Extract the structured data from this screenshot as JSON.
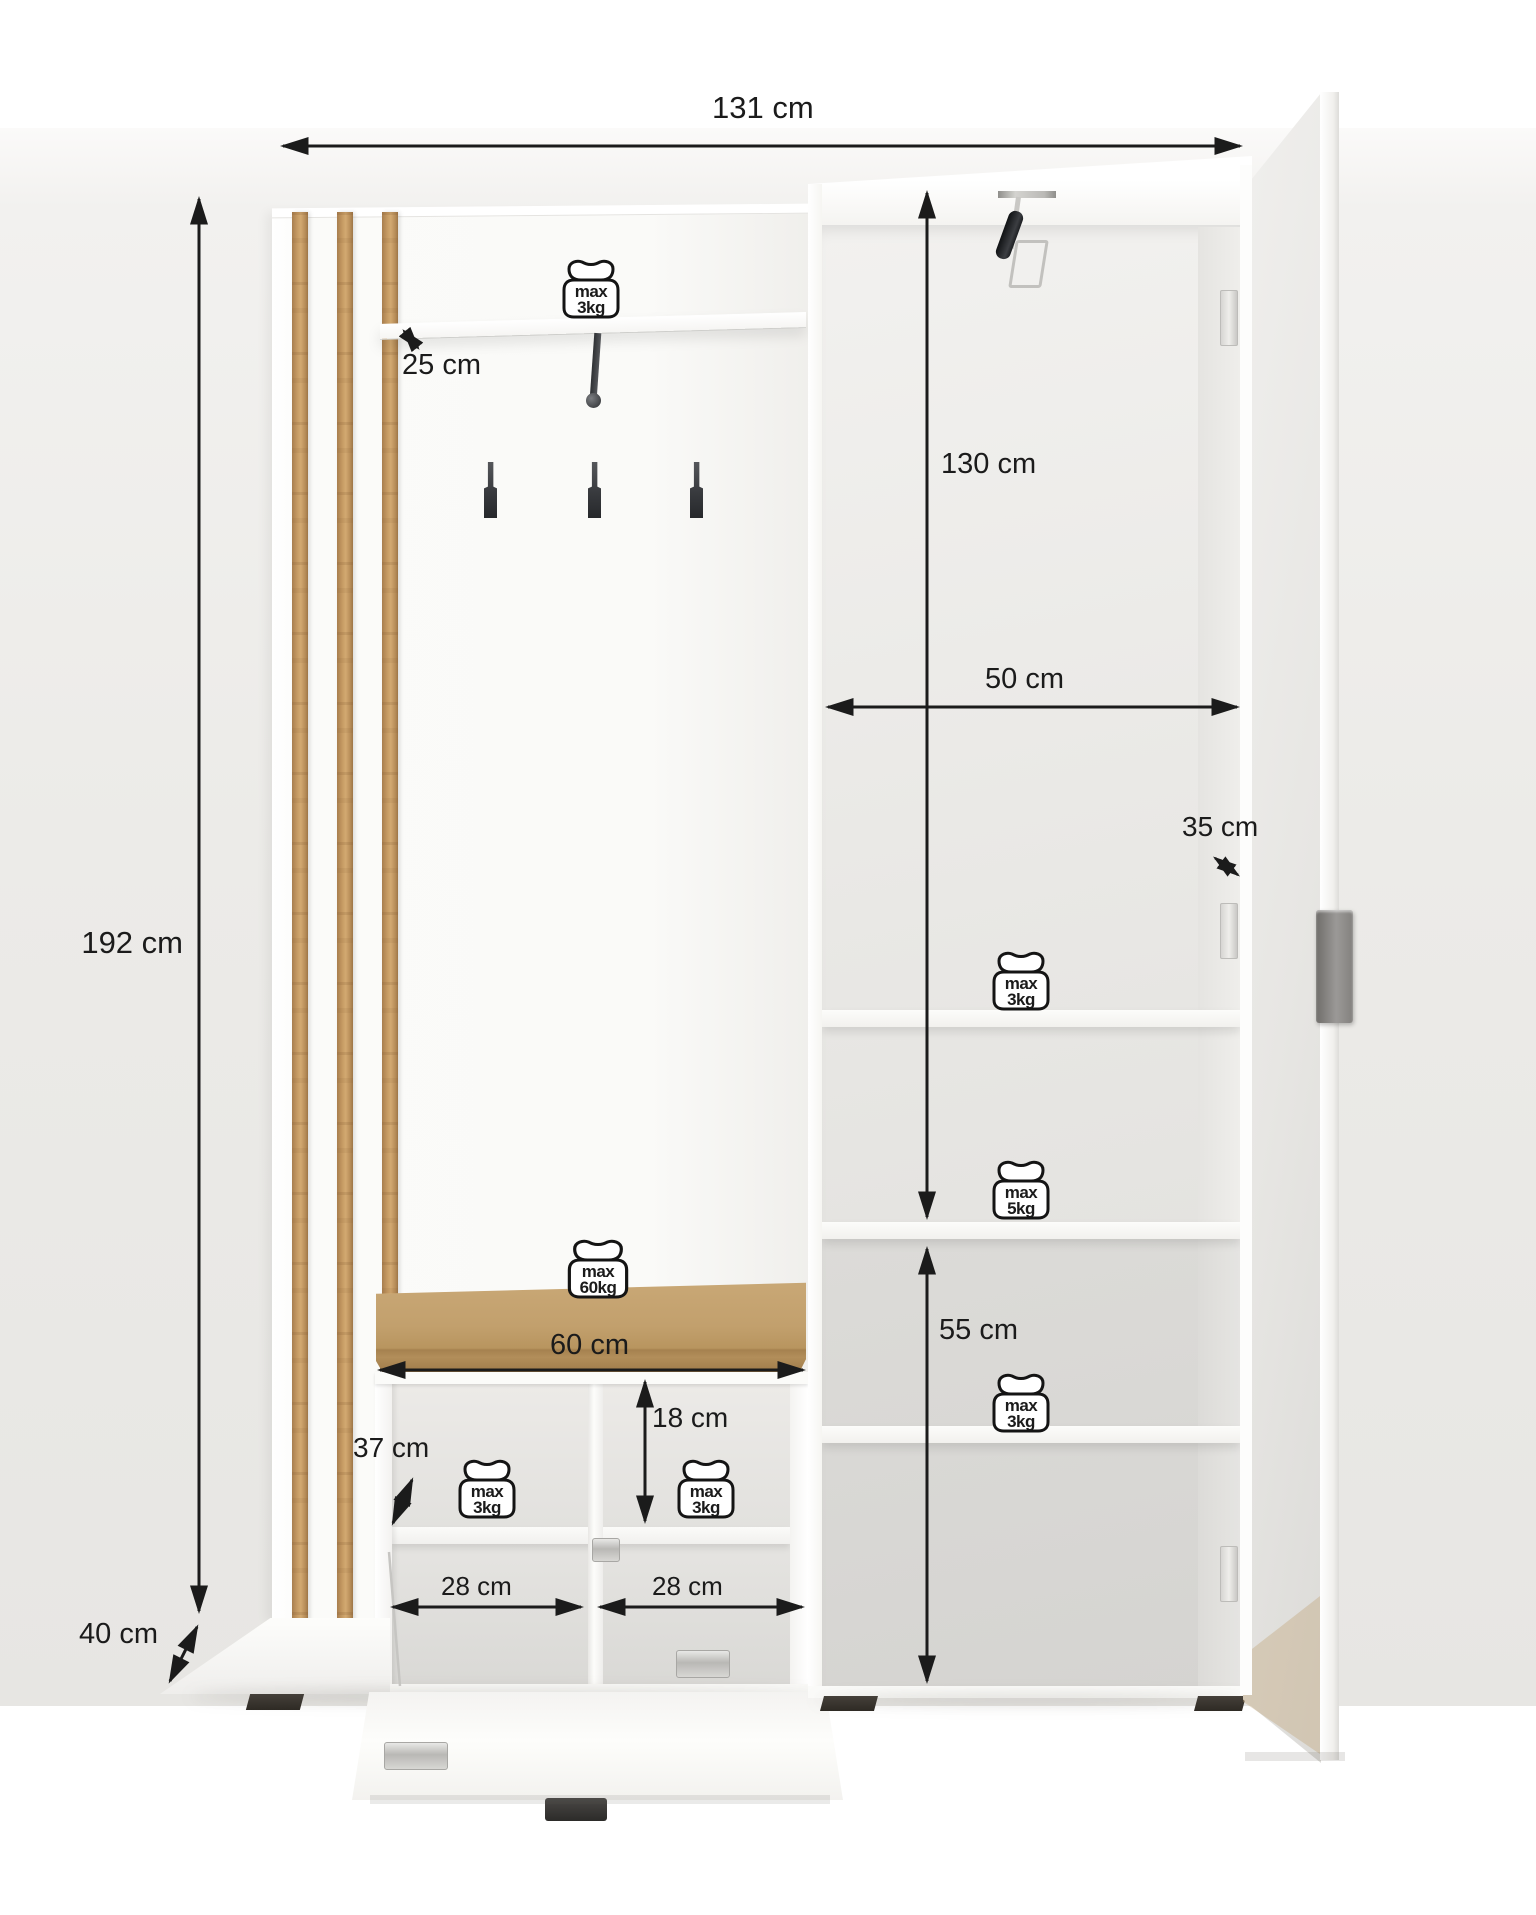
{
  "dimensions": {
    "total_width": {
      "label": "131 cm"
    },
    "total_height": {
      "label": "192 cm"
    },
    "total_depth": {
      "label": "40 cm"
    },
    "hat_shelf_depth": {
      "label": "25 cm"
    },
    "cabinet_inner_height": {
      "label": "130 cm"
    },
    "cabinet_inner_width": {
      "label": "50 cm"
    },
    "cabinet_inner_depth": {
      "label": "35 cm"
    },
    "cabinet_lower_height": {
      "label": "55 cm"
    },
    "bench_width": {
      "label": "60 cm"
    },
    "shoe_compartment_height": {
      "label": "18 cm"
    },
    "shoe_cabinet_depth": {
      "label": "37 cm"
    },
    "shoe_compartment_left_width": {
      "label": "28 cm"
    },
    "shoe_compartment_right_width": {
      "label": "28 cm"
    }
  },
  "load_limits": {
    "hat_shelf": {
      "line1": "max",
      "line2": "3kg"
    },
    "tall_cabinet_top_shelf": {
      "line1": "max",
      "line2": "3kg"
    },
    "tall_cabinet_middle_shelf": {
      "line1": "max",
      "line2": "5kg"
    },
    "tall_cabinet_bottom_shelf": {
      "line1": "max",
      "line2": "3kg"
    },
    "bench_seat": {
      "line1": "max",
      "line2": "60kg"
    },
    "shoe_cabinet_left": {
      "line1": "max",
      "line2": "3kg"
    },
    "shoe_cabinet_right": {
      "line1": "max",
      "line2": "3kg"
    }
  },
  "colors": {
    "dimension_ink": "#1b1b1b",
    "wood": "#c49a63",
    "cushion": "#c0a06e",
    "furniture_white": "#fafaf8",
    "background": "#eceae7"
  }
}
